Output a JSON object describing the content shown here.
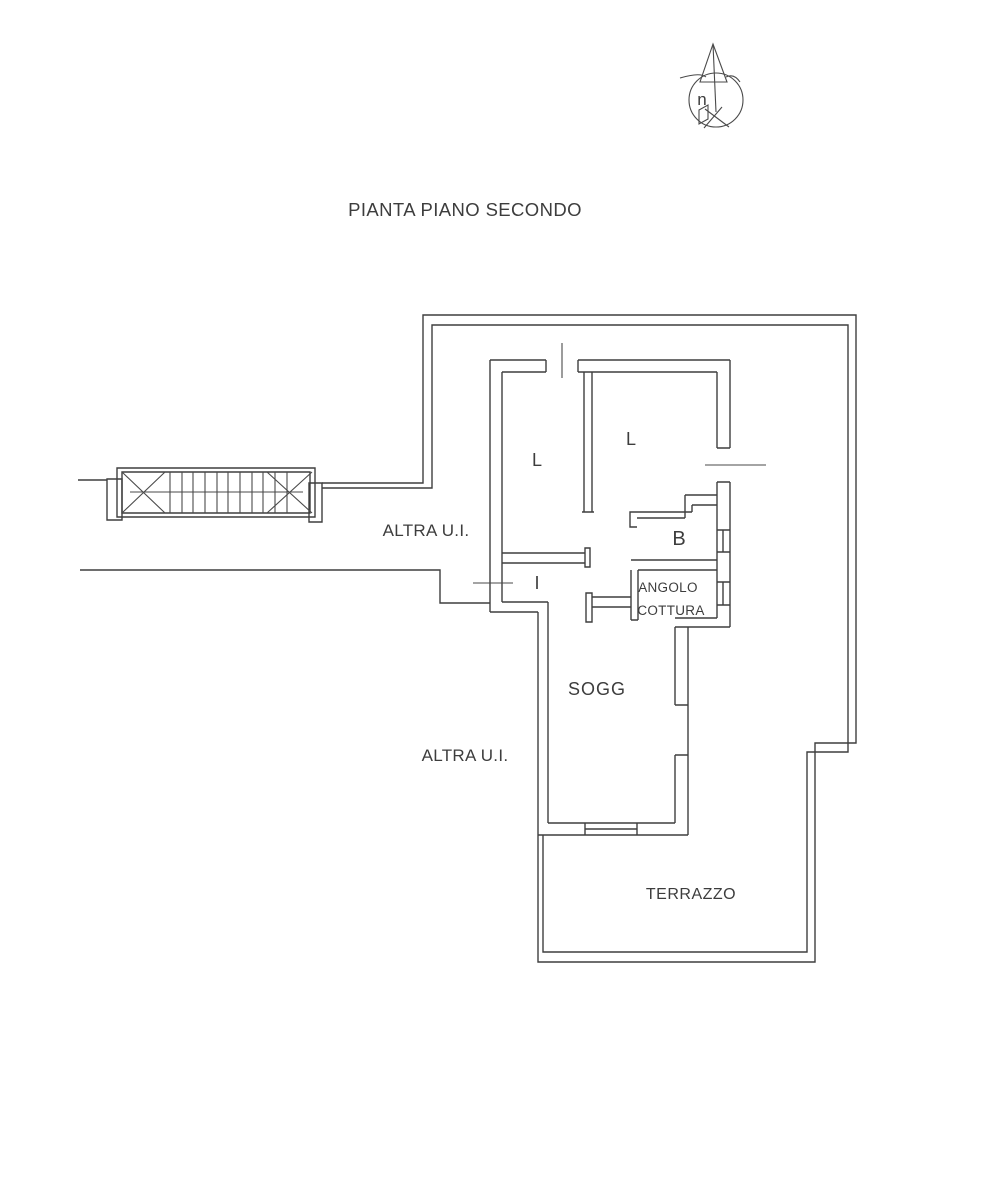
{
  "page": {
    "background": "#ffffff",
    "line_color": "#3f3f3f",
    "text_color": "#3d3d3d"
  },
  "title": "PIANTA PIANO SECONDO",
  "north_indicator": {
    "label": "n"
  },
  "plan": {
    "rooms": [
      {
        "id": "room-l1",
        "label": "L"
      },
      {
        "id": "room-l2",
        "label": "L"
      },
      {
        "id": "room-bath",
        "label": "B"
      },
      {
        "id": "room-entry",
        "label": "I"
      },
      {
        "id": "room-kitchen",
        "label_line1": "ANGOLO",
        "label_line2": "COTTURA"
      },
      {
        "id": "room-living",
        "label": "SOGG"
      },
      {
        "id": "room-terrace",
        "label": "TERRAZZO"
      }
    ],
    "other_units": [
      {
        "id": "altra-ui-upper",
        "label": "ALTRA U.I."
      },
      {
        "id": "altra-ui-lower",
        "label": "ALTRA U.I."
      }
    ]
  }
}
